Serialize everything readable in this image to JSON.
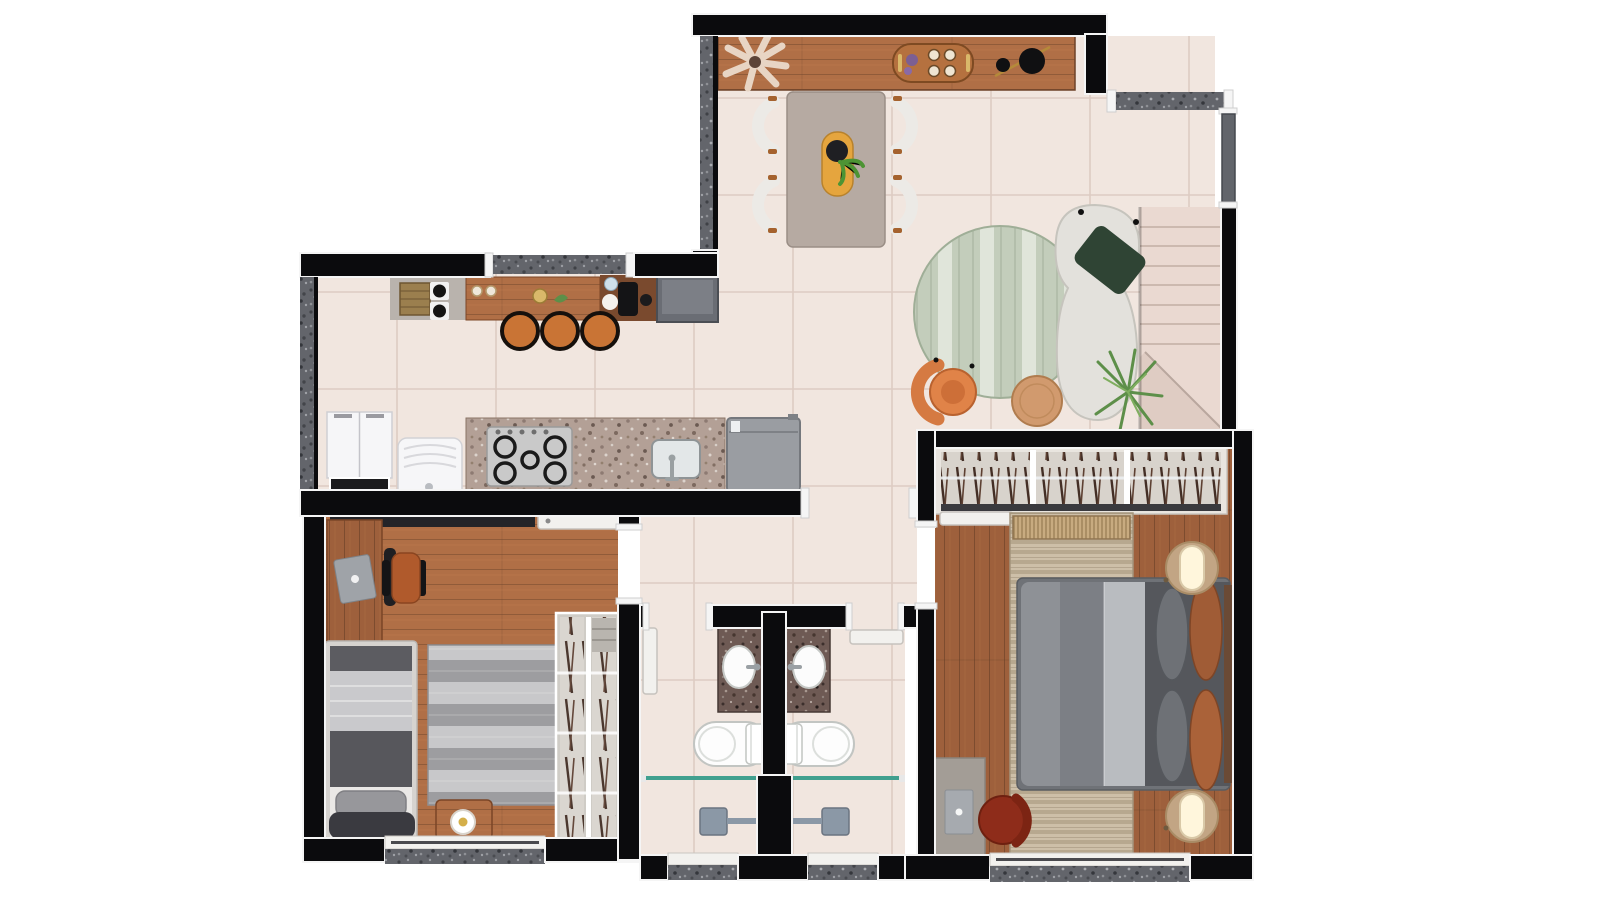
{
  "meta": {
    "type": "floor-plan-rendering",
    "view": "top-down",
    "background": "#ffffff"
  },
  "palette": {
    "wall": "#0b0b0d",
    "wall_outline": "#f5f5f5",
    "hatch_base": "#63656b",
    "floor_tile": "#f1e6df",
    "floor_grout": "#ddccc3",
    "wood_a": "#b06f46",
    "wood_b": "#9e603c",
    "wood_furniture": "#8d5b3f",
    "granite_base": "#b3a096",
    "vanity_granite": "#6e5a54",
    "stair_fill": "#ead9d1",
    "stair_line": "#ccb9af",
    "stair_shadow": "#dfccc3",
    "sofa_white": "#e3e1dc",
    "pillow_green": "#2f4434",
    "rug_green_a": "#c3cdbb",
    "rug_green_b": "#e0e5da",
    "accent_orange": "#e08348",
    "stool_orange": "#c97435",
    "table_taupe": "#b6aaa2",
    "chair_white": "#eceae6",
    "runner_yellow": "#e5a53e",
    "coffee_table_wood": "#d19a6e",
    "appliance_gray": "#9a9da2",
    "fridge_gray": "#6a6d74",
    "appliance_white": "#f6f6f8",
    "desk_gray": "#a39d96",
    "laptop_gray": "#9fa3a8",
    "chair_red": "#8e2c1a",
    "bed_frame_light": "#d6d3cf",
    "bed_band_dark": "#5c5c61",
    "bed_quilt_light": "#c9c9cc",
    "duvet_dark": "#3a3a40",
    "rug_gray_a": "#9d9da0",
    "rug_gray_b": "#c8c8ca",
    "rug_beige_a": "#cdbfa8",
    "rug_beige_b": "#b7a88f",
    "master_duvet": "#8e9196",
    "master_quilt": "#b9bcc0",
    "pillow_rust": "#a05c36",
    "nightstand_tan": "#c2a584",
    "lamp_glow": "#fff6dc",
    "closet_frame": "#e9e5df",
    "closet_inner": "#d8d3cc",
    "wardrobe_frame": "#cfccc6",
    "glass_teal": "#41a08f",
    "shower_gray": "#8b98a6",
    "door_leaf_gray": "#62656b"
  },
  "rooms": [
    {
      "id": "living-dining",
      "furniture": [
        "wood-sideboard",
        "vase-plant",
        "serving-tray",
        "decor-bowls",
        "dining-table",
        "yellow-table-runner",
        "potted-centerpiece",
        "dining-chair x4",
        "round-green-rug",
        "white-sofa",
        "green-throw-pillow",
        "orange-armchair",
        "round-coffee-table",
        "palm-plant",
        "entry-door"
      ]
    },
    {
      "id": "kitchen",
      "furniture": [
        "side-counter",
        "storage-basket",
        "two-burner-hob",
        "wood-breakfast-bar",
        "bar-stool x3",
        "coffee-station",
        "refrigerator",
        "white-base-cabinet",
        "top-load-washer",
        "granite-counter",
        "five-burner-cooktop",
        "kitchen-sink",
        "washing-machine",
        "window"
      ]
    },
    {
      "id": "staircase",
      "furniture": [
        "stair-treads",
        "landing"
      ]
    },
    {
      "id": "hallway",
      "furniture": []
    },
    {
      "id": "bedroom-1",
      "furniture": [
        "wall-shelf",
        "door-leaf",
        "wood-desk",
        "laptop",
        "desk-chair",
        "single-bed",
        "pillow",
        "dark-duvet",
        "striped-gray-rug",
        "wood-ottoman",
        "ring-lamp",
        "open-wardrobe",
        "window"
      ]
    },
    {
      "id": "bathroom-1",
      "furniture": [
        "door-leaf",
        "granite-vanity",
        "oval-sink",
        "faucet",
        "toilet",
        "glass-shower-partition",
        "shower-head",
        "window"
      ]
    },
    {
      "id": "bathroom-2",
      "furniture": [
        "door-leaf",
        "granite-vanity",
        "oval-sink",
        "faucet",
        "toilet",
        "glass-shower-partition",
        "shower-head",
        "window"
      ]
    },
    {
      "id": "bedroom-2",
      "furniture": [
        "open-closet",
        "door-leaf",
        "woven-bench",
        "striped-beige-rug",
        "double-bed",
        "gray-pillow x2",
        "rust-pillow x2",
        "round-nightstand x2",
        "glowing-lamp x2",
        "desk",
        "laptop",
        "red-desk-chair",
        "window"
      ]
    }
  ]
}
